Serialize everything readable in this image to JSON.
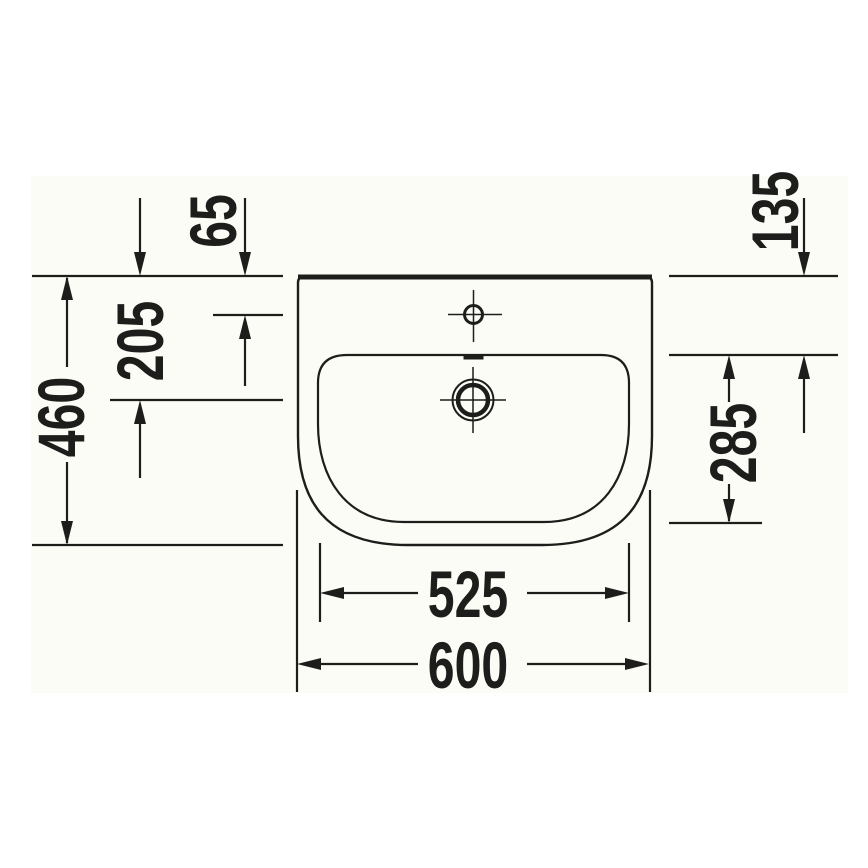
{
  "drawing": {
    "type": "technical-dimension-drawing",
    "view": "washbasin-top-view",
    "line_color": "#1d1d1b",
    "canvas_color": "#fcfcf7",
    "background_color": "#ffffff"
  },
  "dimensions": {
    "tap_hole_from_back_edge": "65",
    "drain_center_from_back_edge": "205",
    "overall_depth": "460",
    "inner_rim_from_back_edge": "135",
    "bowl_inner_depth": "285",
    "bowl_inner_width": "525",
    "overall_width": "600"
  }
}
